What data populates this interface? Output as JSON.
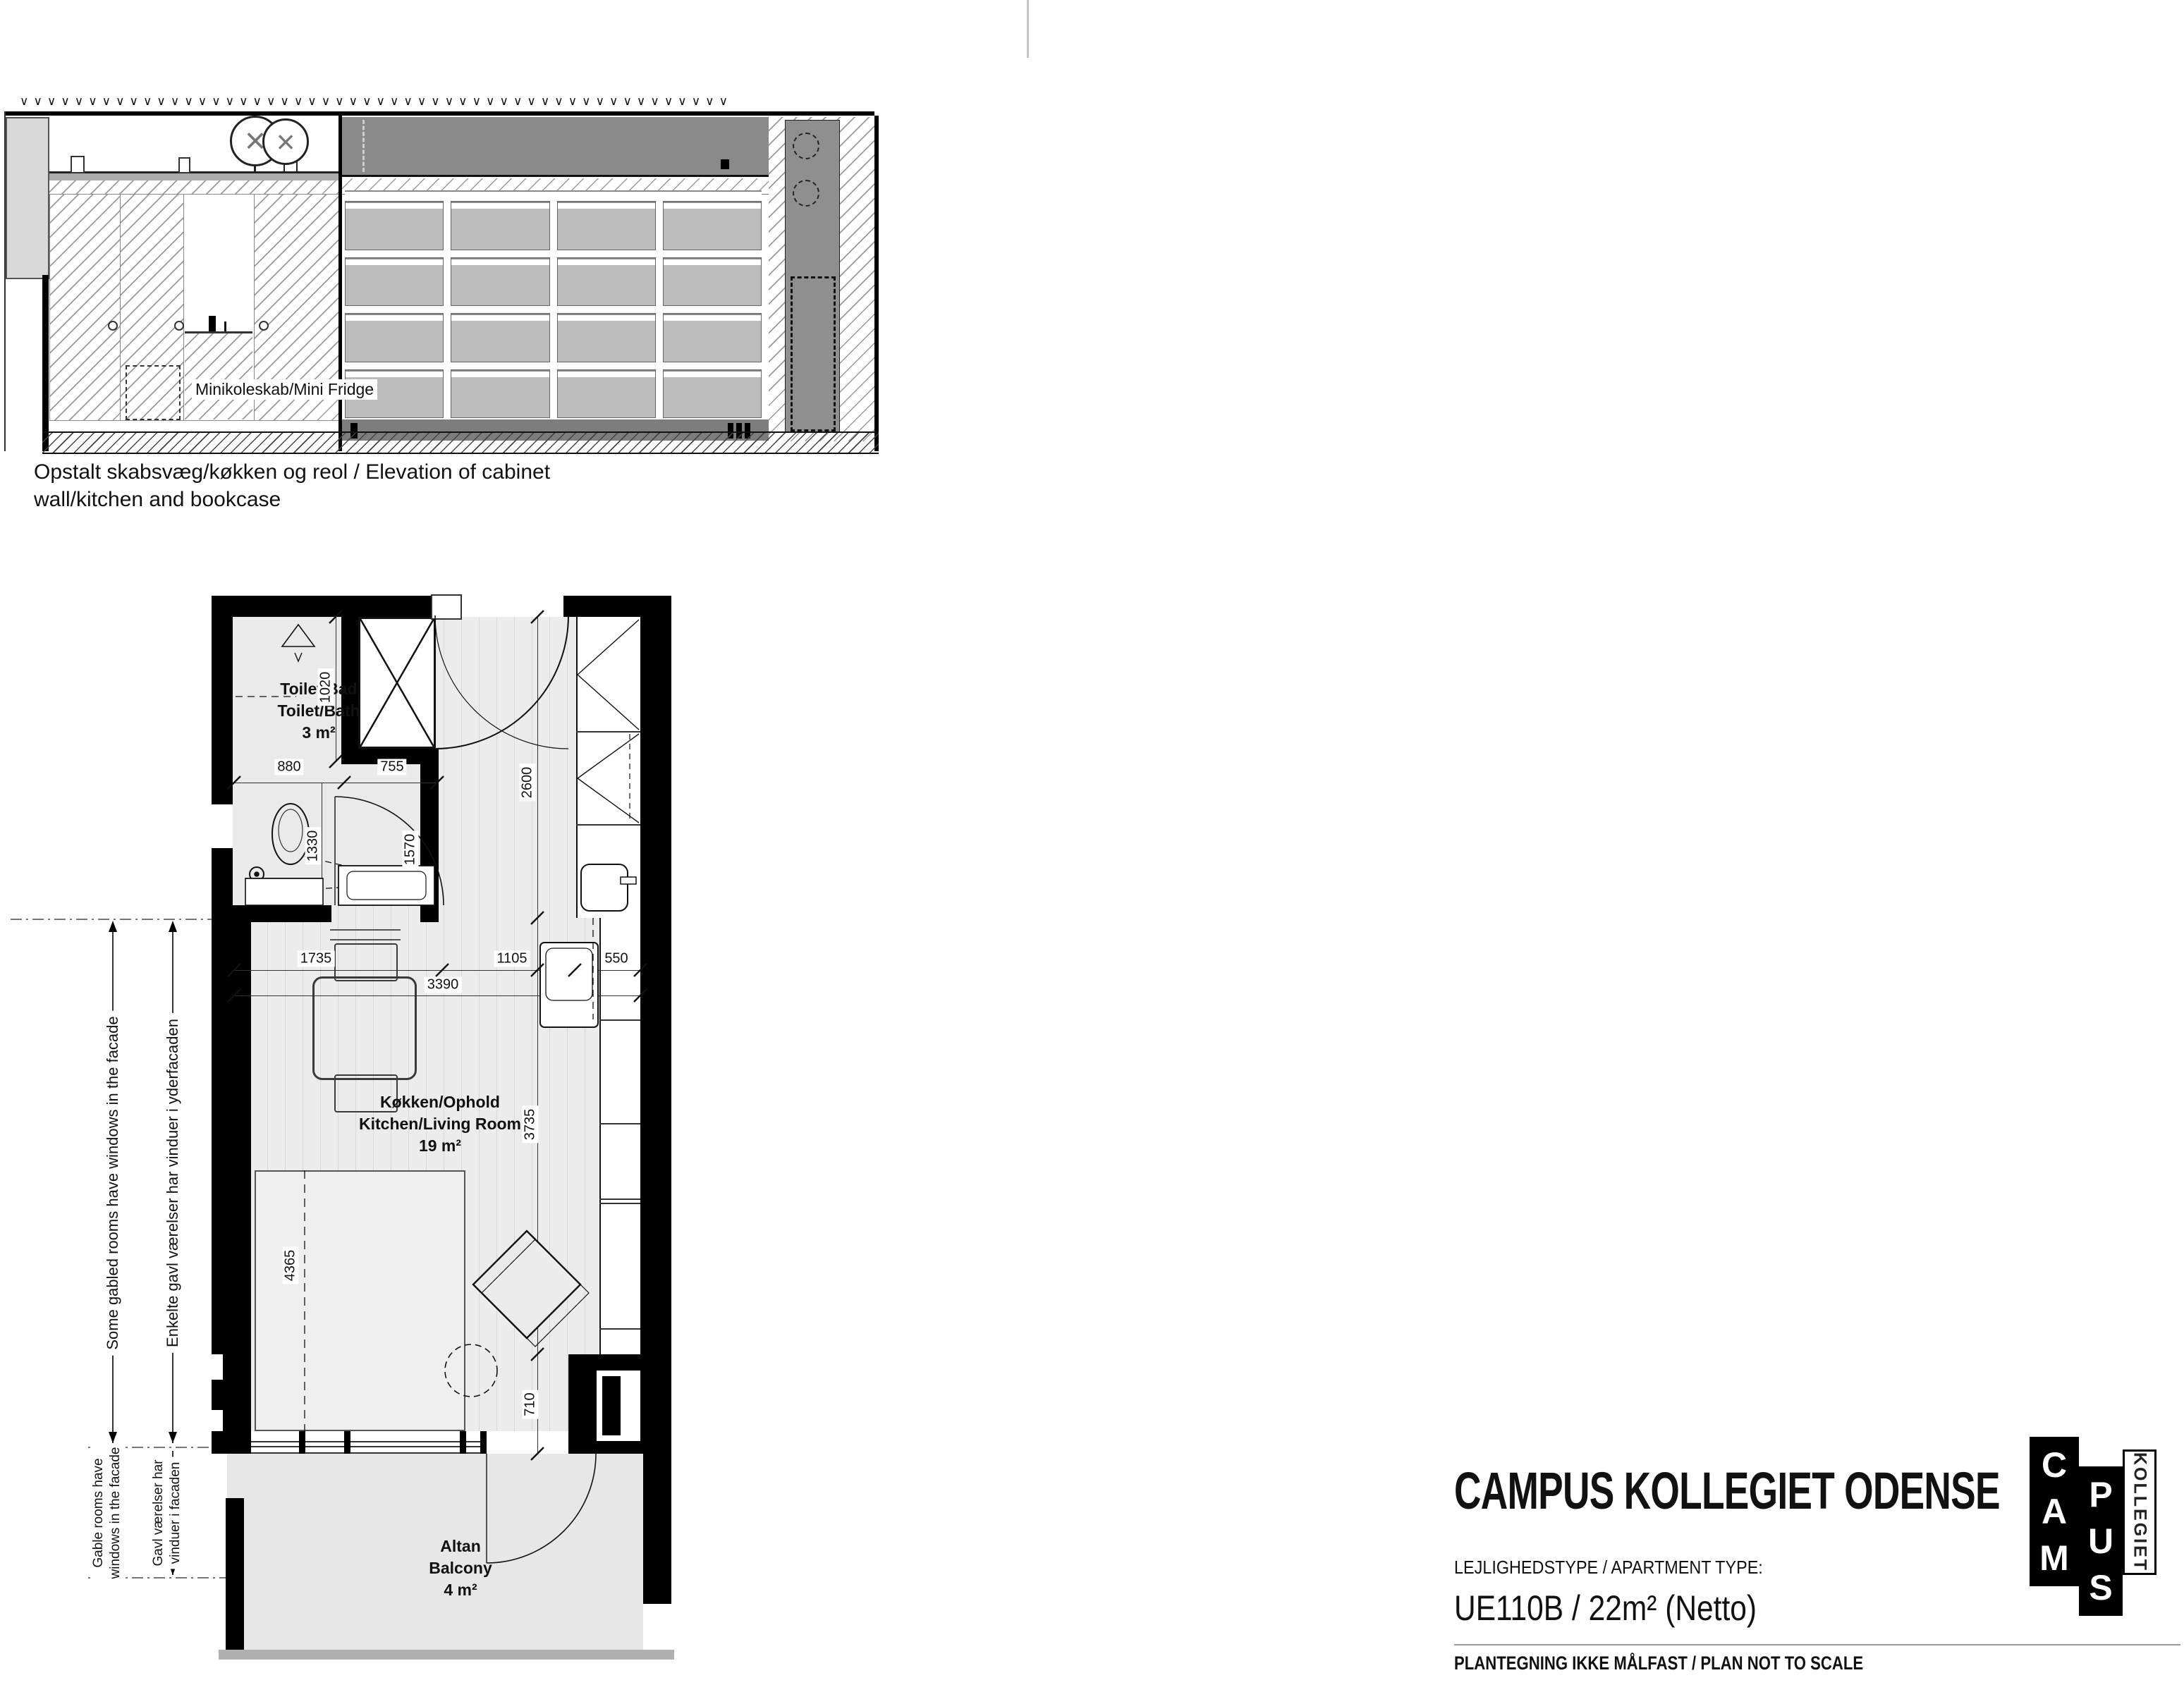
{
  "colors": {
    "wall": "#000000",
    "floor": "#ececec",
    "balcony_floor": "#e7e7e7",
    "dark_band": "#8a8a8a",
    "shelf_cell": "#bdbdbd",
    "ground": "#b0b0b0"
  },
  "fold_mark": {
    "present": true
  },
  "elevation": {
    "roof_marks": {
      "glyph": "∨",
      "count": 52
    },
    "fridge_label": "Minikoleskab/Mini Fridge",
    "caption_line1": "Opstalt skabsvæg/køkken og reol / Elevation of cabinet",
    "caption_line2": "wall/kitchen and bookcase",
    "lamp_glyph": "×"
  },
  "plan": {
    "caption": "Plan / Plan",
    "rooms": {
      "toilet": {
        "line1": "Toilet/Bad",
        "line2": "Toilet/Bath",
        "area": "3 m²"
      },
      "kitchen": {
        "line1": "Køkken/Ophold",
        "line2": "Kitchen/Living Room",
        "area": "19 m²"
      },
      "balcony": {
        "line1": "Altan",
        "line2": "Balcony",
        "area": "4 m²"
      }
    },
    "dims": {
      "v1020": "1020",
      "h880": "880",
      "h755": "755",
      "v1330": "1330",
      "v1570": "1570",
      "v2600": "2600",
      "h1735": "1735",
      "h1105": "1105",
      "h3390": "3390",
      "h550": "550",
      "v3735": "3735",
      "v4365": "4365",
      "v710": "710"
    },
    "annotations": {
      "upper_en": "Some gabled rooms have windows in the facade",
      "upper_da": "Enkelte gavl værelser har vinduer i yderfacaden",
      "lower_en_l1": "Gable rooms have",
      "lower_en_l2": "windows in the facade",
      "lower_da_l1": "Gavl værelser har",
      "lower_da_l2": "vinduer i facaden"
    }
  },
  "title_block": {
    "project": "CAMPUS KOLLEGIET ODENSE",
    "type_label": "LEJLIGHEDSTYPE / APARTMENT TYPE:",
    "type_value": "UE110B / 22m² (Netto)",
    "note": "PLANTEGNING IKKE MÅLFAST / PLAN NOT TO SCALE",
    "logo": {
      "word1": "CAM",
      "word2": "PUS",
      "word3": "KOLLEGIET"
    }
  }
}
